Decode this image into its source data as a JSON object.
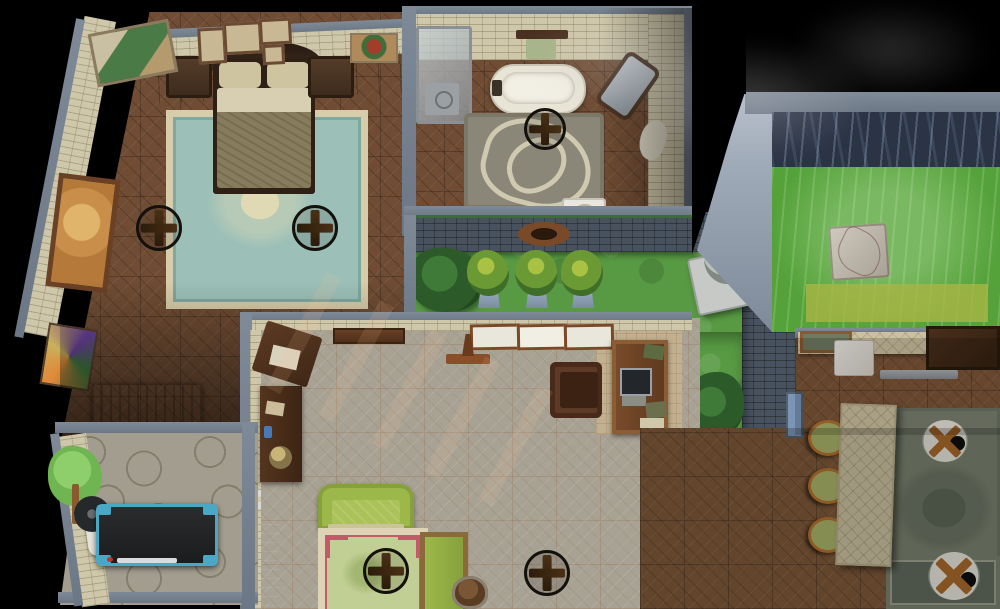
{
  "scene": {
    "description": "night-time top-down dollhouse view of a furnished house in a life-simulation game",
    "hud_text": "none visible",
    "rooms": [
      {
        "name": "bedroom",
        "floor": "dark wood parquet",
        "objects": [
          "double bed",
          "left nightstand",
          "right nightstand",
          "teal damask area rug",
          "ceiling fan",
          "ceiling fan",
          "gallery wall frames",
          "figure painting",
          "redhead portrait",
          "orange abstract painting",
          "colorful abstract painting",
          "radiator"
        ]
      },
      {
        "name": "bathroom",
        "floor": "dark wood parquet",
        "objects": [
          "shower stall",
          "clawfoot bathtub",
          "towel rack",
          "cheval mirror",
          "rose pattern rug",
          "ceiling fan",
          "toilet",
          "dropped towel"
        ]
      },
      {
        "name": "courtyard garden",
        "floor": "grass",
        "objects": [
          "hedge bush",
          "potted topiary",
          "potted topiary",
          "potted topiary",
          "wall lantern",
          "stone statue",
          "lower hedge bush",
          "planter half wall",
          "slate garden wall"
        ]
      },
      {
        "name": "pool terrace",
        "objects": [
          "dark deep water",
          "glowing green water",
          "submerged ledge",
          "stone platform",
          "rising steam"
        ]
      },
      {
        "name": "living room",
        "floor": "pale parquet",
        "objects": [
          "window",
          "window",
          "window",
          "valet stand",
          "wall shelf",
          "console table",
          "globe",
          "stereo chest",
          "green sofa",
          "floral bordered rug",
          "green bench",
          "barrel bin",
          "ceiling fan",
          "ceiling fan",
          "writing desk",
          "computer",
          "desk chair"
        ]
      },
      {
        "name": "gym",
        "floor": "flagstone",
        "objects": [
          "tree wall mural",
          "treadmill",
          "weight bench"
        ]
      },
      {
        "name": "kitchen dining",
        "floor": "wood parquet",
        "objects": [
          "kitchen counter",
          "wooden tray",
          "white appliance",
          "dark cabinet",
          "wall shelf",
          "bar stool",
          "bar stool",
          "bar stool",
          "kitchen island",
          "damask rug",
          "ceiling light",
          "ceiling light",
          "garden window"
        ]
      }
    ]
  },
  "palette": {
    "background": "#000000",
    "wall_gray": "#76828f",
    "stone_wall": "#cfc7a9",
    "slate_wall": "#48525f",
    "parquet_dark": "#6f4c33",
    "parquet_light": "#a8a294",
    "parquet_mid": "#7b5638",
    "flagstone": "#a39d8f",
    "grass": "#589a43",
    "water_dark": "#2b3445",
    "water_green": "#55a23b",
    "pool_step": "#a8b545",
    "rug_teal": "#9cc0b8",
    "rug_border_cream": "#d8cdaa",
    "sofa_green": "#9cb84a",
    "stool_green": "#a9b36a",
    "treadmill_blue": "#4aa8c6",
    "counter_beige": "#cbc1a0"
  }
}
